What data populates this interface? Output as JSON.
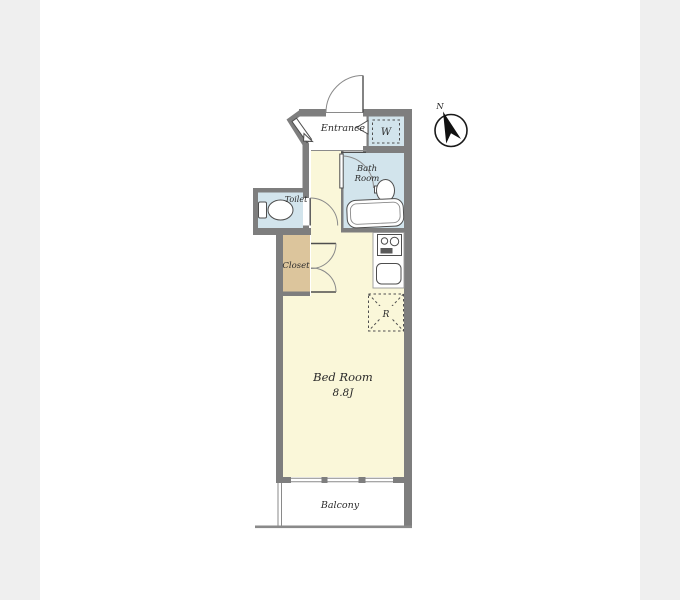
{
  "rooms": {
    "entrance": "Entrance",
    "washer": "W",
    "bath_line1": "Bath",
    "bath_line2": "Room",
    "toilet": "Toilet",
    "closet": "Closet",
    "bedroom_name": "Bed Room",
    "bedroom_size": "8.8J",
    "balcony": "Balcony",
    "refrigerator": "R"
  },
  "compass": {
    "north": "N"
  },
  "colors": {
    "wall": "#7e7e7e",
    "floor_cream": "#faf7d9",
    "wet_area_blue": "#d2e4ec",
    "closet_tan": "#dcc59c",
    "background": "#ffffff",
    "side_strip": "#efefef",
    "compass_arrow": "#111111"
  }
}
